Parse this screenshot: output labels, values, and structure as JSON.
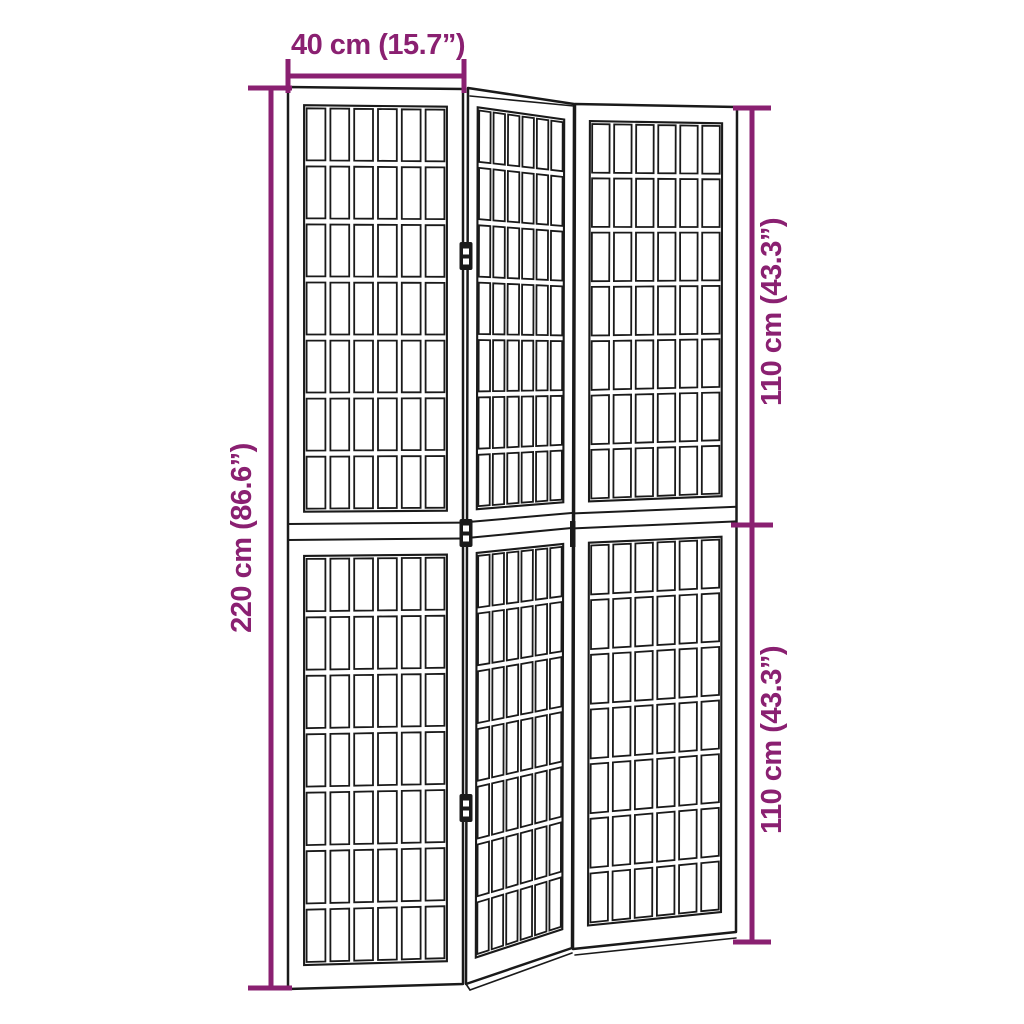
{
  "figure": {
    "type": "product-dimension-diagram",
    "subject": "3-panel folding room divider screen with lattice grid panels"
  },
  "colors": {
    "dimension": "#8A2071",
    "outline": "#1A1A1A",
    "background": "#FFFFFF"
  },
  "dimensions": {
    "top": {
      "label": "40 cm (15.7”)",
      "value_cm": 40,
      "value_in": 15.7
    },
    "left": {
      "label": "220 cm (86.6”)",
      "value_cm": 220,
      "value_in": 86.6
    },
    "right_top": {
      "label": "110 cm (43.3”)",
      "value_cm": 110,
      "value_in": 43.3
    },
    "right_bottom": {
      "label": "110 cm (43.3”)",
      "value_cm": 110,
      "value_in": 43.3
    }
  },
  "screen": {
    "panel_count": 3,
    "sections_per_panel": 2,
    "columns_per_panel": 6,
    "rows_per_section": 7
  }
}
